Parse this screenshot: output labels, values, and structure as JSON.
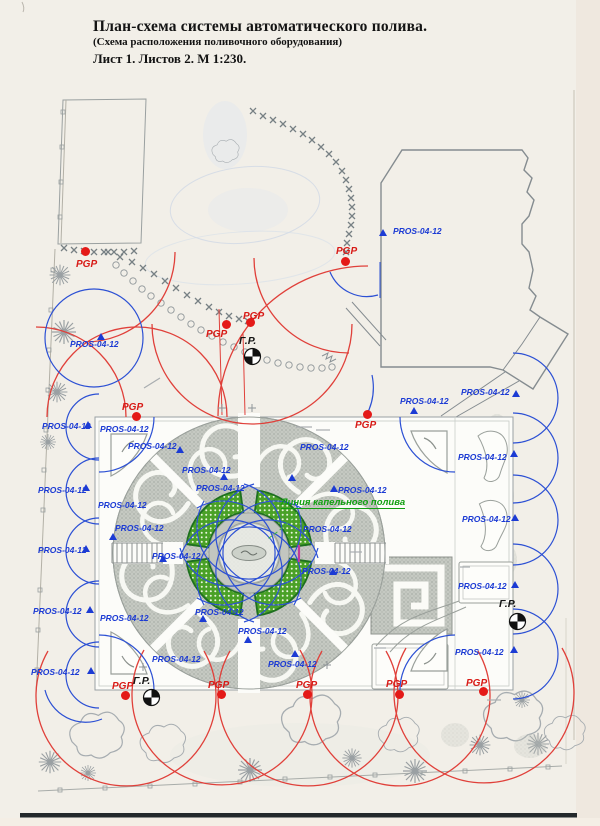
{
  "header": {
    "line1": "План-схема системы автоматического полива.",
    "line2": "(Схема расположения поливочного оборудования)",
    "line3": "Лист 1. Листов 2. М 1:230."
  },
  "labels": {
    "sprinkler": "PROS-04-12",
    "pump": "PGP",
    "distributor": "Г.Р.",
    "drip": "Линия капельного полива"
  },
  "colors": {
    "sprinkler_blue": "#1c3bd4",
    "pgp_red": "#d81a16",
    "drip_green": "#11a011",
    "arc_red": "#e0403a",
    "arc_blue": "#2c50d4",
    "paper": "#f2efe8",
    "parterre_green": "#4aa127"
  },
  "markers": {
    "pros_labels": [
      [
        393,
        226
      ],
      [
        70,
        339
      ],
      [
        42,
        421
      ],
      [
        100,
        424
      ],
      [
        128,
        441
      ],
      [
        182,
        465
      ],
      [
        196,
        483
      ],
      [
        300,
        442
      ],
      [
        338,
        485
      ],
      [
        461,
        387
      ],
      [
        400,
        396
      ],
      [
        38,
        485
      ],
      [
        38,
        545
      ],
      [
        98,
        500
      ],
      [
        115,
        523
      ],
      [
        152,
        551
      ],
      [
        303,
        524
      ],
      [
        302,
        566
      ],
      [
        458,
        452
      ],
      [
        462,
        514
      ],
      [
        33,
        606
      ],
      [
        31,
        667
      ],
      [
        100,
        613
      ],
      [
        195,
        607
      ],
      [
        238,
        626
      ],
      [
        152,
        654
      ],
      [
        268,
        659
      ],
      [
        455,
        647
      ],
      [
        458,
        581
      ]
    ],
    "triangles": [
      [
        383,
        232
      ],
      [
        516,
        393
      ],
      [
        414,
        410
      ],
      [
        514,
        453
      ],
      [
        515,
        517
      ],
      [
        515,
        584
      ],
      [
        514,
        649
      ],
      [
        88,
        424
      ],
      [
        86,
        487
      ],
      [
        86,
        548
      ],
      [
        90,
        609
      ],
      [
        91,
        670
      ],
      [
        101,
        336
      ],
      [
        180,
        449
      ],
      [
        224,
        476
      ],
      [
        292,
        477
      ],
      [
        334,
        488
      ],
      [
        113,
        536
      ],
      [
        163,
        558
      ],
      [
        203,
        618
      ],
      [
        248,
        639
      ],
      [
        295,
        653
      ],
      [
        333,
        571
      ]
    ],
    "pgp": [
      {
        "label": [
          76,
          259
        ],
        "dot": [
          85,
          251
        ]
      },
      {
        "label": [
          336,
          246
        ],
        "dot": [
          345,
          261
        ]
      },
      {
        "label": [
          243,
          311
        ],
        "dot": [
          250,
          322
        ]
      },
      {
        "label": [
          206,
          329
        ],
        "dot": [
          226,
          324
        ]
      },
      {
        "label": [
          122,
          402
        ],
        "dot": [
          136,
          416
        ]
      },
      {
        "label": [
          355,
          420
        ],
        "dot": [
          367,
          414
        ]
      },
      {
        "label": [
          112,
          681
        ],
        "dot": [
          125,
          695
        ]
      },
      {
        "label": [
          208,
          680
        ],
        "dot": [
          221,
          694
        ]
      },
      {
        "label": [
          296,
          680
        ],
        "dot": [
          307,
          694
        ]
      },
      {
        "label": [
          386,
          679
        ],
        "dot": [
          399,
          694
        ]
      },
      {
        "label": [
          466,
          678
        ],
        "dot": [
          483,
          691
        ]
      }
    ],
    "gr": [
      {
        "label": [
          239,
          335
        ],
        "symbol": [
          252,
          356
        ]
      },
      {
        "label": [
          133,
          675
        ],
        "symbol": [
          151,
          697
        ]
      },
      {
        "label": [
          499,
          598
        ],
        "symbol": [
          517,
          621
        ]
      }
    ]
  }
}
